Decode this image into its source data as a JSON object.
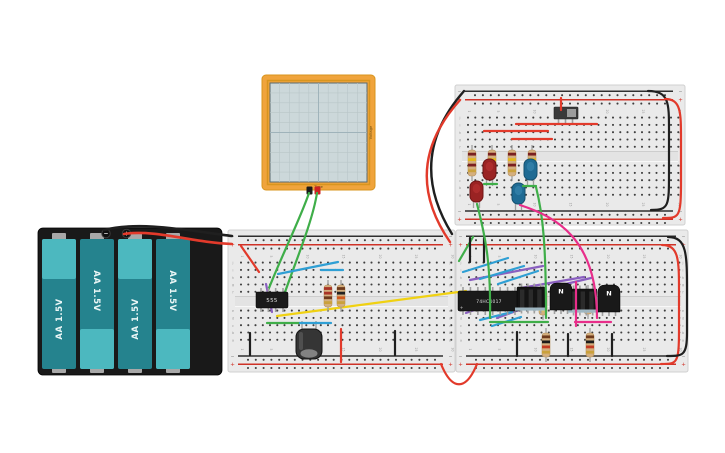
{
  "scene": {
    "w": 725,
    "h": 453,
    "bg": "#ffffff"
  },
  "colors": {
    "wire_red": "#e23a2b",
    "wire_black": "#1f1f1f",
    "wire_green": "#3fae49",
    "wire_blue": "#2f9fd4",
    "wire_yellow": "#f0d112",
    "wire_purple": "#8a5fc0",
    "wire_magenta": "#e82e8a",
    "board": "#eaeaea",
    "board_edge": "#d0d0d0",
    "hole": "#3f3f3f",
    "rail_red": "#cf3227",
    "rail_black": "#2f2f2f",
    "ic_body": "#1a1a1a",
    "ic_text": "#e0e0e0",
    "lead": "#9f9f9f",
    "resistor_body": "#d4af7e",
    "led_red": "#9a2323",
    "led_red_dark": "#701616",
    "led_red_light": "#d24040",
    "led_blue": "#1f6b94",
    "led_blue_dark": "#14506f",
    "led_blue_light": "#4ea0c8",
    "cap_body": "#353535",
    "cap_end": "#8f8f8f",
    "pack": "#191919",
    "battery_dark": "#25838e",
    "battery_light": "#4cb8bf",
    "tab": "#a8a8a8",
    "scope_frame": "#f0a43c",
    "scope_frame_dark": "#d8951e",
    "scope_screen": "#ccd8da",
    "scope_grid": "#b9c6c8",
    "scope_grid_mid": "#9fb3ba",
    "scope_label": "#6b4c12",
    "switch_body": "#3a3a3a",
    "switch_knob": "#9c9c9c",
    "dip_block": "#141414",
    "dip_ridge": "#2b2b2b",
    "dip_strip": "#a7bfca"
  },
  "boards": [
    {
      "id": "board-top-right",
      "x": 455,
      "y": 85,
      "w": 230,
      "h": 140
    },
    {
      "id": "board-lower-left",
      "x": 228,
      "y": 230,
      "w": 227,
      "h": 142
    },
    {
      "id": "board-lower-right",
      "x": 456,
      "y": 230,
      "w": 232,
      "h": 142
    }
  ],
  "board_text": {
    "letters_top": [
      "j",
      "i",
      "h",
      "g",
      "f"
    ],
    "letters_bottom": [
      "e",
      "d",
      "c",
      "b",
      "a"
    ],
    "numbers": [
      1,
      5,
      10,
      15,
      20,
      25,
      30
    ],
    "minus": "−",
    "plus": "+"
  },
  "battery": {
    "x": 38,
    "y": 228,
    "w": 184,
    "h": 147,
    "cells": [
      {
        "label": "AA 1.5V",
        "flip": false
      },
      {
        "label": "AA 1.5V",
        "flip": true
      },
      {
        "label": "AA 1.5V",
        "flip": false
      },
      {
        "label": "AA 1.5V",
        "flip": true
      }
    ],
    "posts": [
      {
        "sign": "−",
        "x": 106
      },
      {
        "sign": "+",
        "x": 126.5
      }
    ]
  },
  "scope": {
    "x": 262,
    "y": 75,
    "w": 113,
    "h": 115,
    "labels": {
      "x": "Time",
      "y": "Voltage"
    }
  },
  "ics": [
    {
      "label": "555",
      "x": 256,
      "y": 292,
      "w": 32,
      "h": 16,
      "pins": 4,
      "fs": 5.5
    },
    {
      "label": "74HC4017",
      "x": 458,
      "y": 291,
      "w": 62,
      "h": 20,
      "pins": 8,
      "fs": 4.4
    }
  ],
  "transistors": [
    {
      "label": "N",
      "x": 550,
      "y": 283
    },
    {
      "label": "N",
      "x": 598,
      "y": 285
    }
  ],
  "dip_blocks": [
    {
      "x": 517,
      "y": 287
    },
    {
      "x": 569,
      "y": 289
    }
  ],
  "slide_switch": {
    "x": 554,
    "y": 107,
    "w": 24,
    "h": 12
  },
  "capacitor": {
    "x": 296,
    "y": 329,
    "w": 26,
    "h": 30
  },
  "resistors": [
    {
      "x": 472,
      "y": 150,
      "len": 26,
      "bands": [
        "#7a2020",
        "#e3b71c",
        "#7a2020",
        "#caa13c"
      ]
    },
    {
      "x": 492,
      "y": 150,
      "len": 26,
      "bands": [
        "#7a2020",
        "#e3b71c",
        "#7a2020",
        "#caa13c"
      ]
    },
    {
      "x": 512,
      "y": 150,
      "len": 26,
      "bands": [
        "#7a2020",
        "#e3b71c",
        "#7a2020",
        "#caa13c"
      ]
    },
    {
      "x": 532,
      "y": 150,
      "len": 26,
      "bands": [
        "#7a2020",
        "#e3b71c",
        "#7a2020",
        "#caa13c"
      ]
    },
    {
      "x": 328,
      "y": 285,
      "len": 22,
      "bands": [
        "#a83426",
        "#a83426",
        "#6e3a1c",
        "#caa13c"
      ]
    },
    {
      "x": 341,
      "y": 285,
      "len": 22,
      "bands": [
        "#6e3a1c",
        "#222222",
        "#cf5a1e",
        "#caa13c"
      ]
    },
    {
      "x": 543,
      "y": 290,
      "len": 25,
      "bands": [
        "#6e3a1c",
        "#222222",
        "#e3b71c",
        "#e3c94a"
      ]
    },
    {
      "x": 588,
      "y": 290,
      "len": 24,
      "bands": [
        "#6e3a1c",
        "#222222",
        "#e3b71c",
        "#e3c94a"
      ]
    },
    {
      "x": 546,
      "y": 333,
      "len": 24,
      "bands": [
        "#6e3a1c",
        "#1c1c1c",
        "#c23b24",
        "#caa13c"
      ]
    },
    {
      "x": 590,
      "y": 333,
      "len": 24,
      "bands": [
        "#6e3a1c",
        "#1c1c1c",
        "#c23b24",
        "#caa13c"
      ]
    }
  ],
  "leds": [
    {
      "x": 483,
      "y": 159,
      "color": "red"
    },
    {
      "x": 524,
      "y": 159,
      "color": "blue"
    },
    {
      "x": 470,
      "y": 181,
      "color": "red"
    },
    {
      "x": 512,
      "y": 183,
      "color": "blue"
    }
  ],
  "wires_under": [
    {
      "c": "green",
      "d": "M309,193 C300,220 277,265 264,301"
    },
    {
      "c": "green",
      "d": "M317,193 C312,225 291,272 280,307"
    },
    {
      "c": "yellow",
      "d": "M277,316 L466,291"
    },
    {
      "c": "purple",
      "d": "M266,284 L272,312"
    },
    {
      "c": "purple",
      "d": "M466,313 L519,294"
    },
    {
      "c": "purple",
      "d": "M497,318 L541,302"
    },
    {
      "c": "purple",
      "d": "M521,288 L584,277"
    },
    {
      "c": "purple",
      "d": "M553,287 L591,278"
    },
    {
      "c": "purple",
      "d": "M470,280 L543,266"
    },
    {
      "c": "blue",
      "d": "M463,272 L508,258"
    },
    {
      "c": "blue",
      "d": "M480,279 L524,266"
    },
    {
      "c": "blue",
      "d": "M498,284 L538,271"
    },
    {
      "c": "blue",
      "d": "M480,320 L512,312"
    },
    {
      "c": "blue",
      "d": "M492,326 L521,317"
    }
  ],
  "wires_over": [
    {
      "c": "black",
      "d": "M104,230 C140,221 185,230 232,236",
      "w": 2.6
    },
    {
      "c": "red",
      "d": "M124,234 C155,229 195,243 232,244",
      "w": 2.6
    },
    {
      "c": "black",
      "d": "M452,234 Q405,158 464,91",
      "w": 2.4
    },
    {
      "c": "red",
      "d": "M450,242 Q399,168 460,100",
      "w": 2.4
    },
    {
      "c": "red",
      "d": "M241,246 L259,272"
    },
    {
      "c": "blue",
      "d": "M278,274 L338,262"
    },
    {
      "c": "blue",
      "d": "M321,270 L343,270"
    },
    {
      "c": "green",
      "d": "M267,323 L300,323"
    },
    {
      "c": "blue",
      "d": "M300,323 L331,323"
    },
    {
      "c": "black",
      "d": "M250,333 L250,355"
    },
    {
      "c": "black",
      "d": "M395,331 L395,355"
    },
    {
      "c": "red",
      "d": "M341,329 L341,362"
    },
    {
      "c": "red",
      "d": "M441,364 C452,391 466,391 477,364"
    },
    {
      "c": "red",
      "d": "M561,98 L561,110"
    },
    {
      "c": "red",
      "d": "M516,124 L597,124"
    },
    {
      "c": "red",
      "d": "M484,131 L548,131"
    },
    {
      "c": "red",
      "d": "M512,139 L552,139"
    },
    {
      "c": "green",
      "d": "M484,184 L497,184"
    },
    {
      "c": "green",
      "d": "M523,186 L536,186"
    },
    {
      "c": "black",
      "d": "M648,91 C669,91 669,103 669,130 L669,172 C669,206 669,210 651,210"
    },
    {
      "c": "red",
      "d": "M665,99 C681,99 681,112 681,140 L681,182 C681,218 679,218 663,218"
    },
    {
      "c": "green",
      "d": "M459,261 L473,237"
    },
    {
      "c": "black",
      "d": "M470,238 L470,262"
    },
    {
      "c": "black",
      "d": "M484,238 L484,262"
    },
    {
      "c": "green",
      "d": "M477,204 C485,235 491,262 490,318"
    },
    {
      "c": "green",
      "d": "M490,322 L548,322"
    },
    {
      "c": "green",
      "d": "M536,187 C543,215 546,245 546,318"
    },
    {
      "c": "magenta",
      "d": "M520,205 C556,217 597,238 597,318"
    },
    {
      "c": "magenta",
      "d": "M576,282 L576,326"
    },
    {
      "c": "magenta",
      "d": "M575,322 L611,322"
    },
    {
      "c": "black",
      "d": "M517,332 L517,356"
    },
    {
      "c": "black",
      "d": "M568,334 L568,356"
    },
    {
      "c": "black",
      "d": "M612,334 L612,356"
    },
    {
      "c": "red",
      "d": "M662,245 C679,245 679,260 679,292 L679,330 C679,364 677,364 661,364"
    },
    {
      "c": "black",
      "d": "M668,237 C687,237 687,254 687,292 L687,332 C687,356 683,356 667,356"
    }
  ]
}
